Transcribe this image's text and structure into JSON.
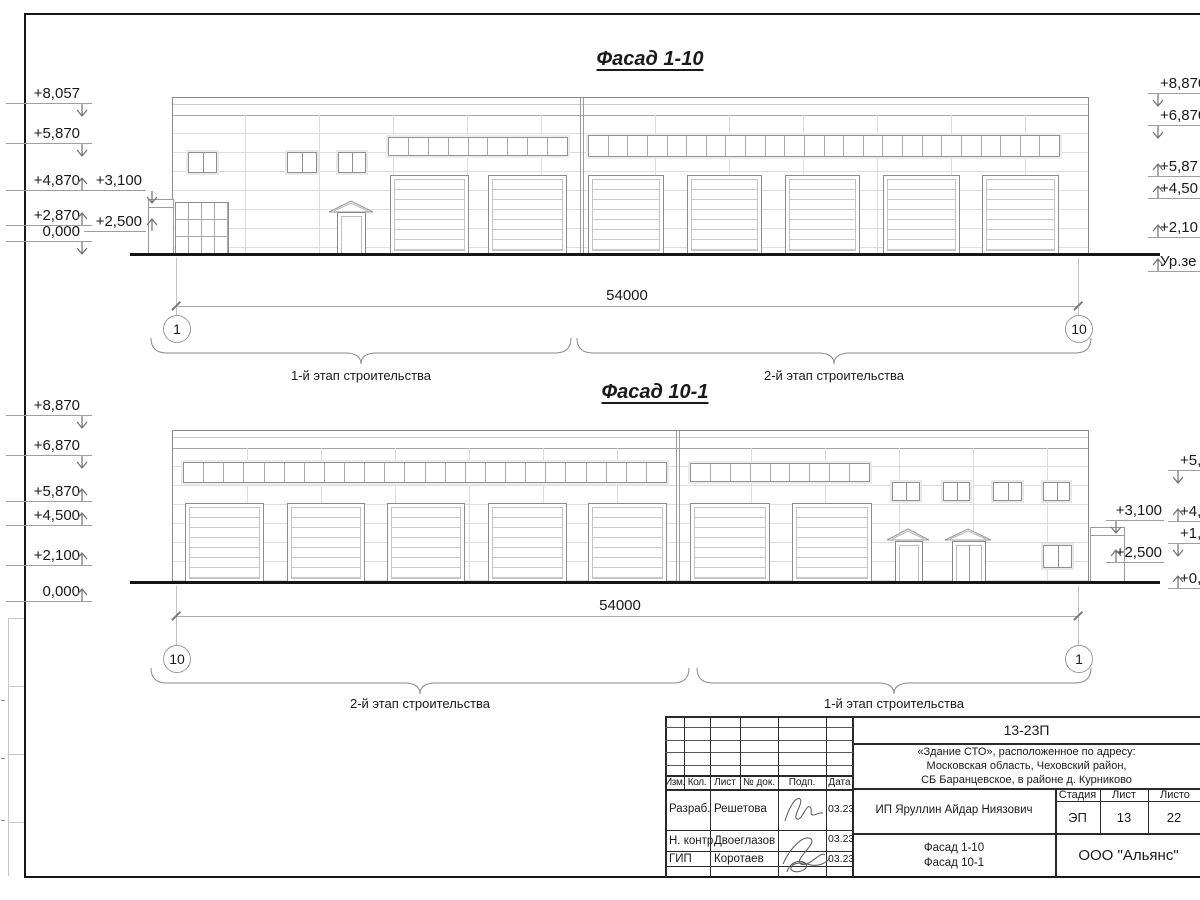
{
  "facade_1_10": {
    "title": "Фасад 1-10",
    "dim": "54000",
    "axis_left": "1",
    "axis_right": "10",
    "stage_left": "1-й этап строительства",
    "stage_right": "2-й этап строительства",
    "marks_left": [
      "+8,057",
      "+5,870",
      "+4,870",
      "+2,870",
      "0,000"
    ],
    "marks_annex": [
      "+3,100",
      "+2,500"
    ],
    "marks_right": [
      "+8,870",
      "+6,870",
      "+5,87",
      "+4,50",
      "+2,10",
      "Ур.зе"
    ]
  },
  "facade_10_1": {
    "title": "Фасад 10-1",
    "dim": "54000",
    "axis_left": "10",
    "axis_right": "1",
    "stage_left": "2-й этап строительства",
    "stage_right": "1-й этап строительства",
    "marks_left": [
      "+8,870",
      "+6,870",
      "+5,870",
      "+4,500",
      "+2,100",
      "0,000"
    ],
    "marks_annex": [
      "+3,100",
      "+2,500"
    ],
    "marks_right": [
      "+5,8",
      "+4,8",
      "+1,8",
      "+0,8"
    ]
  },
  "title_block": {
    "doc_code": "13-23П",
    "address_line1": "«Здание СТО», расположенное по адресу:",
    "address_line2": "Московская область, Чеховский район,",
    "address_line3": "СБ Баранцевское, в районе д. Курниково",
    "header_cols": [
      "Изм.",
      "Кол.",
      "Лист",
      "№ док.",
      "Подп.",
      "Дата"
    ],
    "rows": [
      {
        "role": "Разраб.",
        "name": "Решетова",
        "date": "03.23"
      },
      {
        "role": "Н. контр.",
        "name": "Двоеглазов",
        "date": "03.23"
      },
      {
        "role": "ГИП",
        "name": "Коротаев",
        "date": "03.23"
      }
    ],
    "client": "ИП Яруллин Айдар Ниязович",
    "stage_label": "Стадия",
    "sheet_label": "Лист",
    "sheets_label": "Листо",
    "stage": "ЭП",
    "sheet": "13",
    "sheets": "22",
    "drawing_line1": "Фасад 1-10",
    "drawing_line2": "Фасад 10-1",
    "company": "ООО \"Альянс\""
  }
}
